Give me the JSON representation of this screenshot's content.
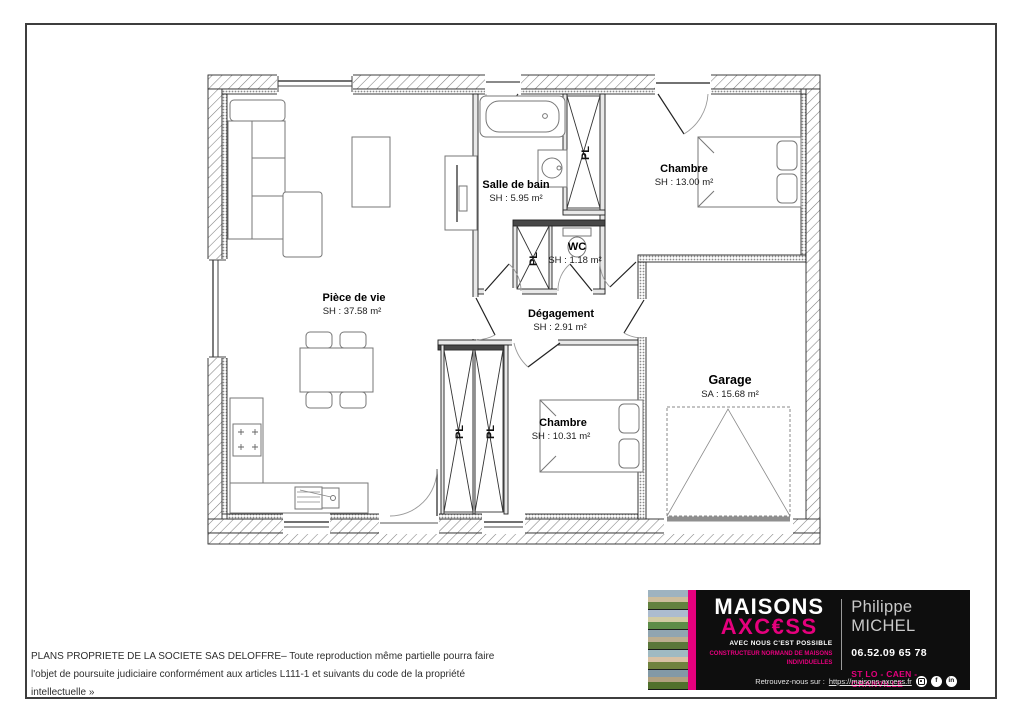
{
  "plan": {
    "rooms": [
      {
        "name": "Salle de bain",
        "area": "SH : 5.95 m²"
      },
      {
        "name": "WC",
        "area": "SH : 1.18 m²"
      },
      {
        "name": "Chambre",
        "area": "SH : 13.00 m²"
      },
      {
        "name": "Pièce de vie",
        "area": "SH : 37.58 m²"
      },
      {
        "name": "Dégagement",
        "area": "SH : 2.91 m²"
      },
      {
        "name": "Chambre",
        "area": "SH : 10.31 m²"
      },
      {
        "name": "Garage",
        "area": "SA : 15.68 m²"
      }
    ],
    "closet_label": "PL"
  },
  "legal": {
    "line1": "PLANS PROPRIETE DE LA SOCIETE SAS DELOFFRE– Toute reproduction même partielle pourra faire",
    "line2": "l'objet de poursuite judiciaire conformément aux articles L111-1 et suivants du code de la propriété",
    "line3": "intellectuelle »"
  },
  "brand": {
    "name_part1": "MAISONS",
    "name_part2": "AXC€SS",
    "tagline": "AVEC NOUS C'EST POSSIBLE",
    "subtitle_line1": "CONSTRUCTEUR NORMAND DE MAISONS",
    "subtitle_line2": "INDIVIDUELLES",
    "contact_name": "Philippe MICHEL",
    "phone": "06.52.09 65 78",
    "cities": "ST LO - CAEN - GRANVILLE",
    "footer_prefix": "Retrouvez-nous sur :",
    "footer_url": "https://maisons-axcess.fr",
    "accent_color": "#e5007d",
    "social_icons": [
      "instagram-icon",
      "facebook-icon",
      "linkedin-icon"
    ],
    "facebook_glyph": "f",
    "linkedin_glyph": "in"
  }
}
